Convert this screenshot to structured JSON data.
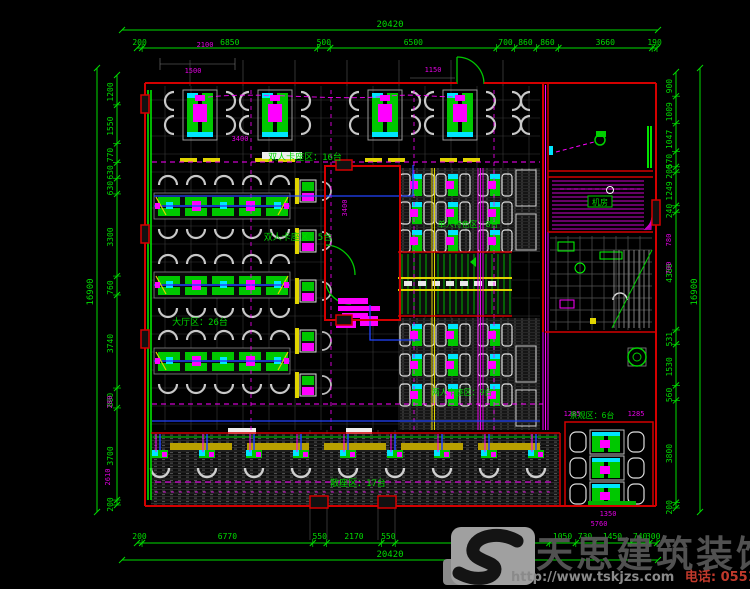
{
  "drawing": {
    "zones": {
      "top_booth": "双人卡座区：16台",
      "left_booth_small": "双人卡座区：5台",
      "hall": "大厅区：26台",
      "single_feature": "单人特色区：8台",
      "two_person": "两人卡座区：9台",
      "scatter": "散座区：17台",
      "view": "景观区：6台",
      "machine_room": "机房"
    },
    "dimensions": {
      "top": {
        "overall": "20420",
        "segments": [
          "200",
          "6850",
          "500",
          "6500",
          "700",
          "860",
          "860",
          "3660",
          "190"
        ]
      },
      "bottom": {
        "overall": "20420",
        "segments": [
          "200",
          "6770",
          "550",
          "2170",
          "550",
          "6110",
          "1050",
          "730",
          "1450",
          "740",
          "300"
        ]
      },
      "left": {
        "overall": "16900",
        "segments": [
          "1200",
          "1550",
          "770",
          "630",
          "630",
          "3300",
          "760",
          "3740",
          "800",
          "3700",
          "200"
        ]
      },
      "right": {
        "overall": "16900",
        "segments": [
          "900",
          "1009",
          "1047",
          "570",
          "200",
          "1249",
          "240",
          "4380",
          "531",
          "1530",
          "560",
          "3800",
          "200"
        ]
      },
      "sub_dims": [
        "2100",
        "1500",
        "1150",
        "3400",
        "3400",
        "280",
        "2610",
        "780",
        "700",
        "1285",
        "1285",
        "5760",
        "1350"
      ]
    }
  },
  "watermark": {
    "brand": "天思建筑装饰",
    "url": "http://www.tskjzs.com",
    "phone": "电话: 0551-65568226"
  },
  "colors": {
    "background": "#000000",
    "wall": "#d40000",
    "dim_text": "#00dc00",
    "sub_dim_text": "#e000e0",
    "furniture_green": "#00c800",
    "wire_magenta": "#ff00ff",
    "accent_cyan": "#00e5ff",
    "accent_yellow": "#e0d400",
    "accent_blue": "#2244ff"
  }
}
